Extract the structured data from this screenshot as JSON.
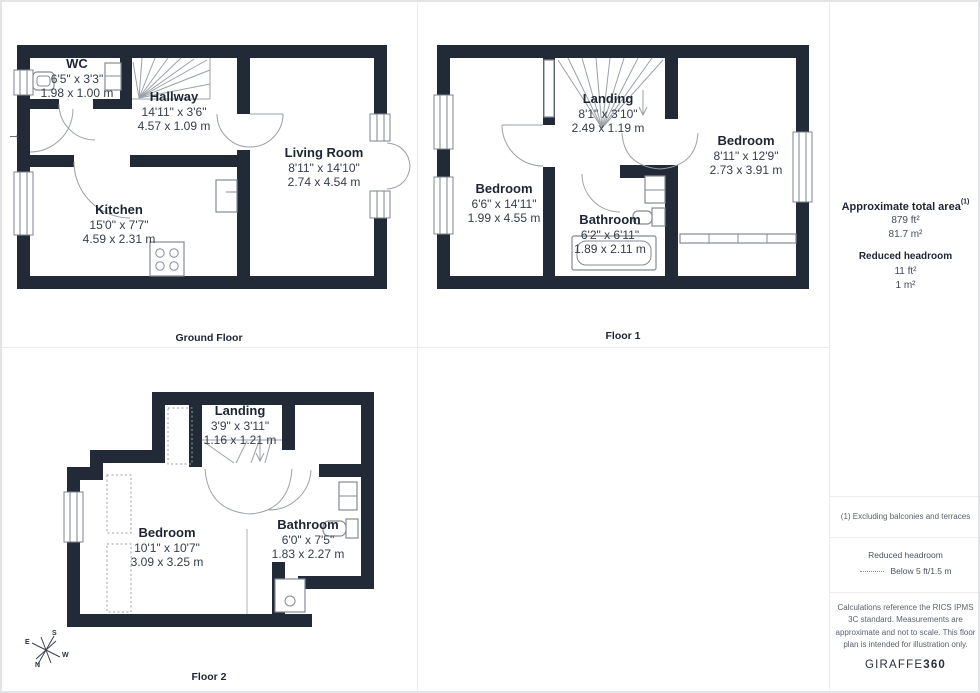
{
  "panels": {
    "ground_floor": {
      "label": "Ground Floor",
      "entrance_arrow": "→",
      "rooms": [
        {
          "name": "WC",
          "imperial": "6'5\" x 3'3\"",
          "metric": "1.98 x 1.00 m"
        },
        {
          "name": "Hallway",
          "imperial": "14'11\" x 3'6\"",
          "metric": "4.57 x 1.09 m"
        },
        {
          "name": "Kitchen",
          "imperial": "15'0\" x 7'7\"",
          "metric": "4.59 x 2.31 m"
        },
        {
          "name": "Living Room",
          "imperial": "8'11\" x 14'10\"",
          "metric": "2.74 x 4.54 m"
        }
      ]
    },
    "floor_1": {
      "label": "Floor 1",
      "rooms": [
        {
          "name": "Landing",
          "imperial": "8'1\" x 3'10\"",
          "metric": "2.49 x 1.19 m"
        },
        {
          "name": "Bedroom",
          "imperial": "6'6\" x 14'11\"",
          "metric": "1.99 x 4.55 m"
        },
        {
          "name": "Bedroom",
          "imperial": "8'11\" x 12'9\"",
          "metric": "2.73 x 3.91 m"
        },
        {
          "name": "Bathroom",
          "imperial": "6'2\" x 6'11\"",
          "metric": "1.89 x 2.11 m"
        }
      ]
    },
    "floor_2": {
      "label": "Floor 2",
      "rooms": [
        {
          "name": "Landing",
          "imperial": "3'9\" x 3'11\"",
          "metric": "1.16 x 1.21 m"
        },
        {
          "name": "Bedroom",
          "imperial": "10'1\" x 10'7\"",
          "metric": "3.09 x 3.25 m"
        },
        {
          "name": "Bathroom",
          "imperial": "6'0\" x 7'5\"",
          "metric": "1.83 x 2.27 m"
        }
      ],
      "compass": {
        "n": "N",
        "e": "E",
        "s": "S",
        "w": "W"
      }
    }
  },
  "sidebar": {
    "total_area": {
      "title": "Approximate total area",
      "superscript": "(1)",
      "imperial": "879 ft²",
      "metric": "81.7 m²"
    },
    "reduced_headroom": {
      "title": "Reduced headroom",
      "imperial": "11 ft²",
      "metric": "1 m²"
    },
    "footnote": "(1) Excluding balconies and terraces",
    "legend": {
      "title": "Reduced headroom",
      "item": "Below 5 ft/1.5 m"
    },
    "disclaimer": "Calculations reference the RICS IPMS 3C standard. Measurements are approximate and not to scale. This floor plan is intended for illustration only.",
    "brand": {
      "name": "GIRAFFE",
      "suffix": "360"
    }
  },
  "colors": {
    "wall": "#222A38",
    "line": "#9AA0A8",
    "text": "#1D2533"
  }
}
